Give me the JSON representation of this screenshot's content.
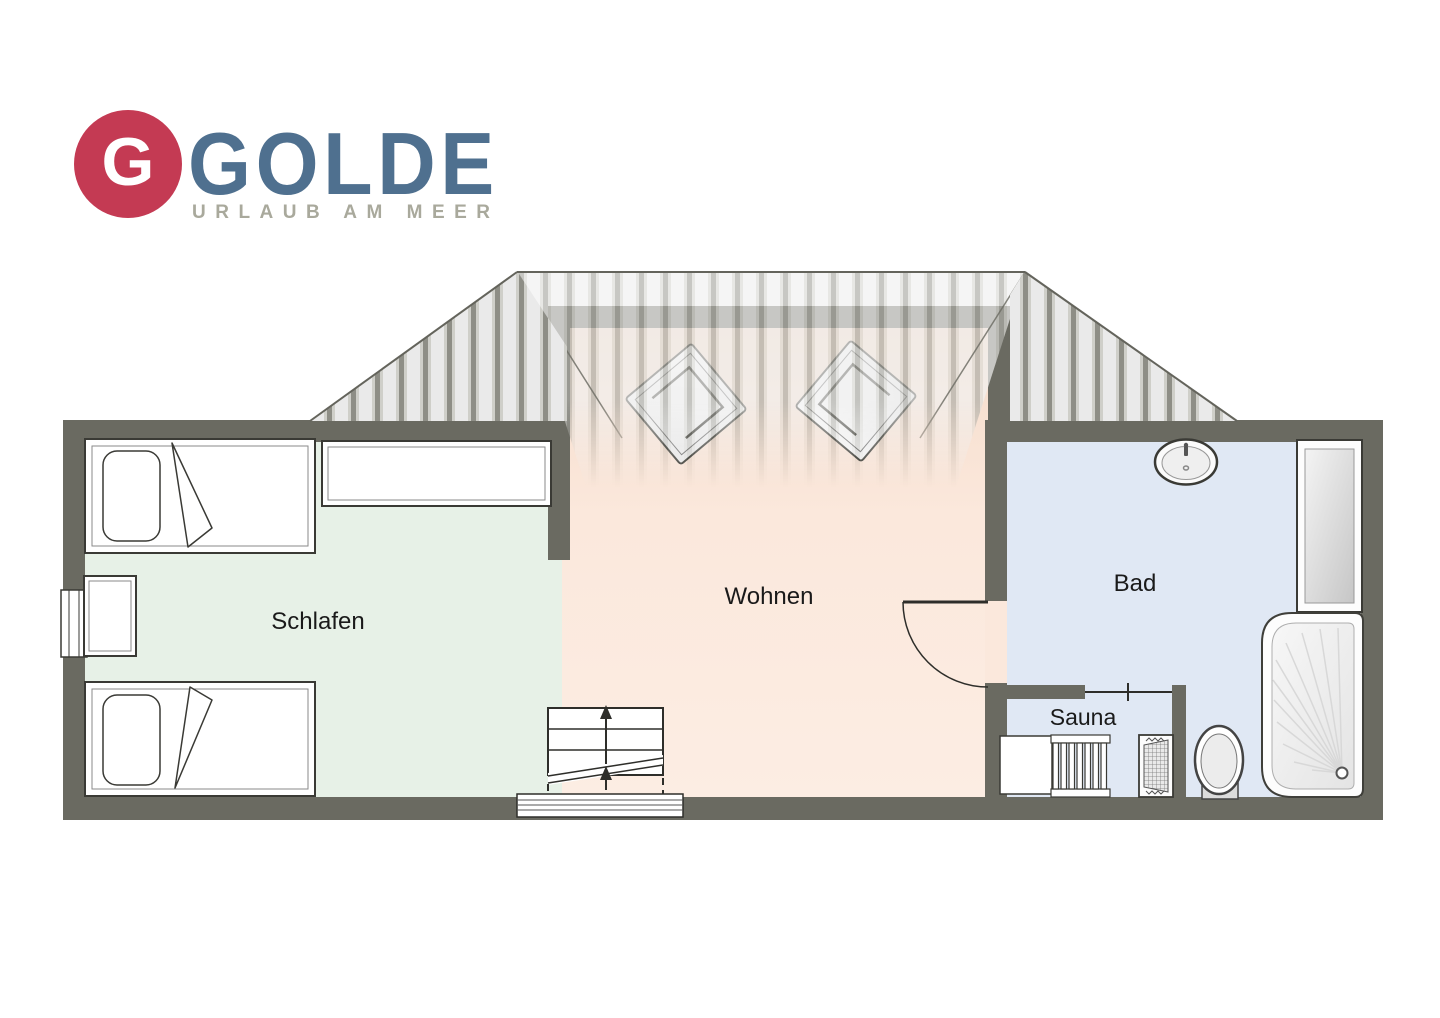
{
  "logo": {
    "monogram": "G",
    "brand": "GOLDE",
    "tagline": "URLAUB AM MEER"
  },
  "rooms": {
    "schlafen": {
      "label": "Schlafen"
    },
    "wohnen": {
      "label": "Wohnen"
    },
    "bad": {
      "label": "Bad"
    },
    "sauna": {
      "label": "Sauna"
    }
  },
  "plan": {
    "furniture": [
      "single-bed-top",
      "single-bed-bottom",
      "wardrobe",
      "nightstand",
      "window",
      "armchair-left",
      "armchair-right",
      "stairs-up",
      "stairs-landing",
      "door-bad",
      "door-sauna",
      "sink",
      "mirror-cabinet",
      "shower",
      "toilet",
      "sauna-bench",
      "radiator",
      "sauna-heater",
      "hip-roof"
    ]
  },
  "colors": {
    "logo_red": "#c43a53",
    "logo_blue": "#4f708f",
    "tagline_gray": "#a9a99c",
    "wall": "#6a6a61",
    "floor_schlafen": "#e7f1e7",
    "floor_wohnen": "#fbe8dc",
    "floor_bad": "#e0e8f4",
    "roof_light": "#eaeaea",
    "roof_stripe": "#8e8e86",
    "outline": "#3a3a35"
  }
}
